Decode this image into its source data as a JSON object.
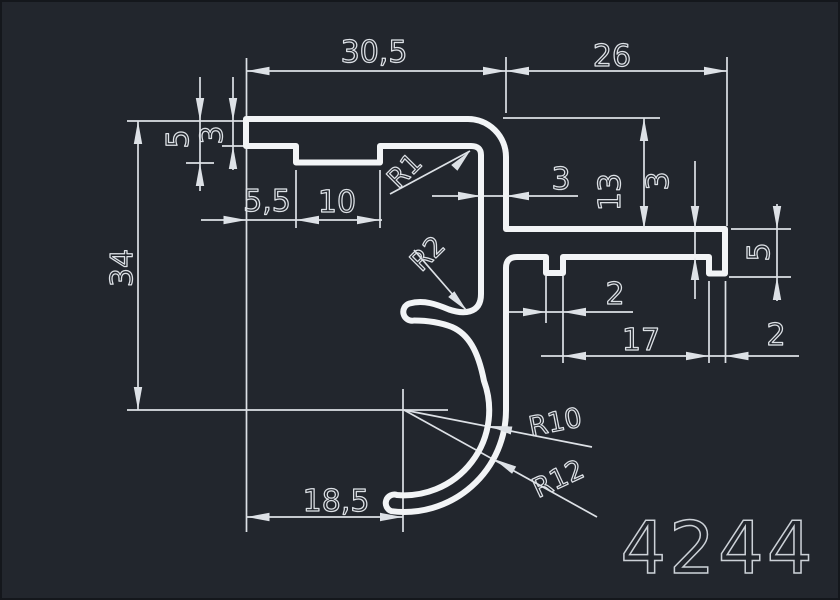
{
  "title": "Aluminium profile cross-section drawing",
  "part": {
    "number": "4244"
  },
  "dimensions_mm": {
    "horizontal": [
      "30,5",
      "26",
      "5,5",
      "10",
      "18,5",
      "3",
      "2",
      "17",
      "2"
    ],
    "vertical": [
      "5",
      "3",
      "34",
      "13",
      "3",
      "5"
    ],
    "radii": [
      "R1",
      "R2",
      "R10",
      "R12"
    ]
  },
  "colors": {
    "background": "#22262d",
    "edge": "#14171c",
    "profile_stroke": "#f2f4f6",
    "dimension_stroke": "#dde1e6",
    "text_stroke": "#dde1e6",
    "part_number_stroke": "#ccd1d7"
  },
  "drawing": {
    "width": 840,
    "height": 600,
    "profile": {
      "name": "profile-outline",
      "stroke_width": 6,
      "path": "M 246 119 L 468 119 A 38 38 0 0 1 506 157 L 506 229 L 725 229 L 725 273.5 L 709 273.5 L 709 257 L 563 257 L 563 273 L 546 273 L 546 257 L 517 257 Q 506 257 506 268 L 506 410 A 102 102 0 0 1 391.6 511.2 A 8.5 8.5 0 0 1 397 495 A 85 85 0 0 0 484 381 C 478 350 468 334 452 327 C 438 321.5 424 320.5 414 320.5 A 8.8 8.8 0 0 1 409.5 303.5 C 424 299.5 437 304.5 449 309.5 C 462 314 481 315 481 294 L 481 155 Q 481 146 471 146 L 380 146 L 380 162.5 L 296 162.5 L 296 146 L 246 146 Z"
    },
    "extension_lines": [
      {
        "n": "ext-left-end",
        "p": [
          246.5,
          58,
          246.5,
          532
        ]
      },
      {
        "n": "ext-stem-outer",
        "p": [
          506,
          57,
          506,
          113
        ]
      },
      {
        "n": "ext-arm-right",
        "p": [
          727,
          57,
          727,
          226
        ]
      },
      {
        "n": "ext-top-surface",
        "p": [
          127,
          121,
          243,
          121
        ]
      },
      {
        "n": "ext-wall3-left",
        "p": [
          222,
          146,
          245,
          146
        ]
      },
      {
        "n": "ext-rib5-left",
        "p": [
          186,
          163,
          214,
          163
        ]
      },
      {
        "n": "ext-rib-left",
        "p": [
          296,
          170,
          296,
          228
        ]
      },
      {
        "n": "ext-rib-right",
        "p": [
          380,
          170,
          380,
          228
        ]
      },
      {
        "n": "ext-center-horiz",
        "p": [
          127,
          410,
          448,
          410
        ]
      },
      {
        "n": "ext-center-vert",
        "p": [
          403,
          389,
          403,
          532
        ]
      },
      {
        "n": "ext-top-right",
        "p": [
          503,
          118,
          660,
          118
        ]
      },
      {
        "n": "ext-notch-left",
        "p": [
          546,
          276,
          546,
          323
        ]
      },
      {
        "n": "ext-notch-right",
        "p": [
          563,
          276,
          563,
          363
        ]
      },
      {
        "n": "ext-lip-left",
        "p": [
          709,
          281,
          709,
          363
        ]
      },
      {
        "n": "ext-lip-right",
        "p": [
          725.5,
          281,
          725.5,
          363
        ]
      },
      {
        "n": "ext-arm-top-right",
        "p": [
          731,
          229,
          791,
          229
        ]
      },
      {
        "n": "ext-lip-bot-right",
        "p": [
          729,
          277,
          791,
          277
        ]
      }
    ],
    "dimension_lines": [
      {
        "n": "dimline-top",
        "p": [
          246.5,
          71,
          727,
          71
        ]
      },
      {
        "n": "dimline-5-left",
        "p": [
          200,
          77,
          200,
          191
        ]
      },
      {
        "n": "dimline-3-left",
        "p": [
          233,
          77,
          233,
          170
        ]
      },
      {
        "n": "dimline-55-10",
        "p": [
          201,
          220,
          382,
          220
        ]
      },
      {
        "n": "dimline-34",
        "p": [
          138,
          121,
          138,
          410
        ]
      },
      {
        "n": "dimline-18-5",
        "p": [
          246.5,
          517,
          403,
          517
        ]
      },
      {
        "n": "dimline-13",
        "p": [
          644,
          118,
          644,
          229
        ]
      },
      {
        "n": "dimline-3-arm",
        "p": [
          695,
          161,
          695,
          299
        ]
      },
      {
        "n": "dimline-3-stem",
        "p": [
          432,
          196,
          578,
          196
        ]
      },
      {
        "n": "dimline-5-right",
        "p": [
          777,
          204,
          777,
          301
        ]
      },
      {
        "n": "dimline-17-2",
        "p": [
          541,
          356,
          799,
          356
        ]
      },
      {
        "n": "dimline-2-notch",
        "p": [
          508,
          312,
          633,
          312
        ]
      }
    ],
    "leader_lines": [
      {
        "n": "leader-r1",
        "p": [
          390,
          194,
          470,
          151
        ]
      },
      {
        "n": "leader-r2",
        "p": [
          414,
          250,
          467,
          311
        ]
      },
      {
        "n": "leader-r10",
        "p": [
          404,
          410,
          592,
          447
        ]
      },
      {
        "n": "leader-r12",
        "p": [
          404,
          410,
          597,
          517
        ]
      }
    ],
    "arrows": [
      {
        "n": "arrow-30-5-left",
        "x": 246.5,
        "y": 71,
        "a": 180
      },
      {
        "n": "arrow-30-5-right",
        "x": 506,
        "y": 71,
        "a": 0
      },
      {
        "n": "arrow-26-left",
        "x": 506,
        "y": 71,
        "a": 180
      },
      {
        "n": "arrow-26-right",
        "x": 727,
        "y": 71,
        "a": 0
      },
      {
        "n": "arrow-5-top",
        "x": 200,
        "y": 121,
        "a": 90
      },
      {
        "n": "arrow-5-bottom",
        "x": 200,
        "y": 163,
        "a": 270
      },
      {
        "n": "arrow-3l-top",
        "x": 233,
        "y": 121,
        "a": 90
      },
      {
        "n": "arrow-3l-bottom",
        "x": 233,
        "y": 146,
        "a": 270
      },
      {
        "n": "arrow-55-left",
        "x": 246.5,
        "y": 220,
        "a": 0
      },
      {
        "n": "arrow-55-right",
        "x": 296,
        "y": 220,
        "a": 180
      },
      {
        "n": "arrow-10-right",
        "x": 380,
        "y": 220,
        "a": 0
      },
      {
        "n": "arrow-34-top",
        "x": 138,
        "y": 121,
        "a": 270
      },
      {
        "n": "arrow-34-bottom",
        "x": 138,
        "y": 410,
        "a": 90
      },
      {
        "n": "arrow-18-5-left",
        "x": 246.5,
        "y": 517,
        "a": 180
      },
      {
        "n": "arrow-18-5-right",
        "x": 403,
        "y": 517,
        "a": 0
      },
      {
        "n": "arrow-13-top",
        "x": 644,
        "y": 118,
        "a": 270
      },
      {
        "n": "arrow-13-bottom",
        "x": 644,
        "y": 229,
        "a": 90
      },
      {
        "n": "arrow-3arm-top",
        "x": 695,
        "y": 229,
        "a": 90
      },
      {
        "n": "arrow-3arm-bottom",
        "x": 695,
        "y": 257,
        "a": 270
      },
      {
        "n": "arrow-3stem-left",
        "x": 481,
        "y": 196,
        "a": 0
      },
      {
        "n": "arrow-3stem-right",
        "x": 506,
        "y": 196,
        "a": 180
      },
      {
        "n": "arrow-5r-top",
        "x": 777,
        "y": 229,
        "a": 90
      },
      {
        "n": "arrow-5r-bottom",
        "x": 777,
        "y": 277,
        "a": 270
      },
      {
        "n": "arrow-17-left",
        "x": 563,
        "y": 356,
        "a": 180
      },
      {
        "n": "arrow-17-right",
        "x": 709,
        "y": 356,
        "a": 0
      },
      {
        "n": "arrow-2lip-right",
        "x": 725.5,
        "y": 356,
        "a": 180
      },
      {
        "n": "arrow-2notch-left",
        "x": 546,
        "y": 312,
        "a": 0
      },
      {
        "n": "arrow-2notch-right",
        "x": 563,
        "y": 312,
        "a": 180
      },
      {
        "n": "arrow-r1",
        "x": 470,
        "y": 151,
        "a": -47
      },
      {
        "n": "arrow-r2",
        "x": 467,
        "y": 311,
        "a": 47
      },
      {
        "n": "arrow-r10",
        "x": 489,
        "y": 426,
        "a": 191
      },
      {
        "n": "arrow-r12",
        "x": 494,
        "y": 459,
        "a": 209
      }
    ],
    "labels": [
      {
        "t": "30,5",
        "x": 374,
        "y": 62,
        "s": 30,
        "r": 0,
        "n": "dim-label-30-5"
      },
      {
        "t": "26",
        "x": 612,
        "y": 66,
        "s": 30,
        "r": 0,
        "n": "dim-label-26"
      },
      {
        "t": "5",
        "x": 188,
        "y": 139,
        "s": 30,
        "r": -90,
        "n": "dim-label-5-left"
      },
      {
        "t": "3",
        "x": 222,
        "y": 135,
        "s": 30,
        "r": -90,
        "n": "dim-label-3-left"
      },
      {
        "t": "5,5",
        "x": 267,
        "y": 211,
        "s": 30,
        "r": 0,
        "n": "dim-label-5-5"
      },
      {
        "t": "10",
        "x": 337,
        "y": 212,
        "s": 30,
        "r": 0,
        "n": "dim-label-10"
      },
      {
        "t": "34",
        "x": 132,
        "y": 268,
        "s": 30,
        "r": -90,
        "n": "dim-label-34"
      },
      {
        "t": "18,5",
        "x": 336,
        "y": 511,
        "s": 30,
        "r": 0,
        "n": "dim-label-18-5"
      },
      {
        "t": "13",
        "x": 620,
        "y": 192,
        "s": 30,
        "r": -90,
        "n": "dim-label-13"
      },
      {
        "t": "3",
        "x": 668,
        "y": 181,
        "s": 30,
        "r": -90,
        "n": "dim-label-3-arm"
      },
      {
        "t": "3",
        "x": 561,
        "y": 189,
        "s": 30,
        "r": 0,
        "n": "dim-label-3-stem"
      },
      {
        "t": "5",
        "x": 769,
        "y": 252,
        "s": 30,
        "r": -90,
        "n": "dim-label-5-right"
      },
      {
        "t": "2",
        "x": 776,
        "y": 345,
        "s": 30,
        "r": 0,
        "n": "dim-label-2-lip"
      },
      {
        "t": "17",
        "x": 641,
        "y": 350,
        "s": 30,
        "r": 0,
        "n": "dim-label-17"
      },
      {
        "t": "2",
        "x": 615,
        "y": 304,
        "s": 30,
        "r": 0,
        "n": "dim-label-2-notch"
      },
      {
        "t": "R1",
        "x": 411,
        "y": 177,
        "s": 27,
        "r": -45,
        "n": "radius-label-r1"
      },
      {
        "t": "R2",
        "x": 434,
        "y": 260,
        "s": 27,
        "r": -45,
        "n": "radius-label-r2"
      },
      {
        "t": "R10",
        "x": 557,
        "y": 431,
        "s": 27,
        "r": -11,
        "n": "radius-label-r10"
      },
      {
        "t": "R12",
        "x": 562,
        "y": 487,
        "s": 27,
        "r": -25,
        "n": "radius-label-r12"
      }
    ],
    "part_label": {
      "t": "4244",
      "x": 718,
      "y": 573,
      "s": 72,
      "n": "part-number"
    },
    "arrow_geometry": {
      "length": 23,
      "half_width": 4.2
    },
    "line_weights": {
      "profile": 6,
      "dimension": 1.7
    }
  }
}
